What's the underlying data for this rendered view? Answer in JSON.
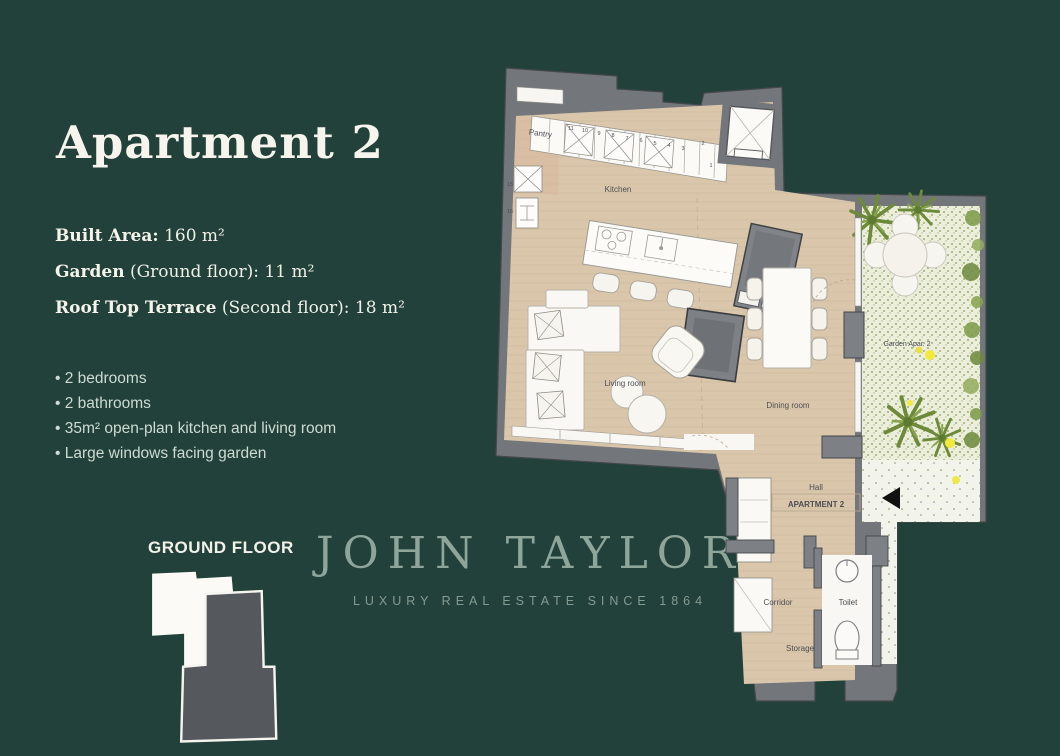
{
  "page": {
    "background": "#22413a"
  },
  "panel": {
    "title": "Apartment 2",
    "specs": [
      {
        "label": "Built Area:",
        "rest": " 160 m²"
      },
      {
        "label": "Garden",
        "rest": " (Ground floor): 11 m²"
      },
      {
        "label": "Roof Top Terrace",
        "rest": " (Second floor): 18 m²"
      }
    ],
    "features": [
      "2 bedrooms",
      "2 bathrooms",
      "35m² open-plan kitchen and living room",
      "Large windows facing garden"
    ],
    "floor_label": "GROUND FLOOR"
  },
  "watermark": {
    "brand": "JOHN TAYLOR",
    "tagline": "LUXURY REAL ESTATE SINCE 1864"
  },
  "plan": {
    "labels": {
      "pantry": "Pantry",
      "kitchen": "Kitchen",
      "living": "Living room",
      "dining": "Dining room",
      "garden": "Garden Apar. 2",
      "hall": "Hall",
      "apartment": "APARTMENT 2",
      "corridor": "Corridor",
      "toilet": "Toilet",
      "storage": "Storage"
    },
    "numbers": {
      "strip": [
        "11",
        "10",
        "9",
        "8",
        "7",
        "6",
        "5",
        "4",
        "3",
        "2"
      ],
      "end": "1",
      "left_top": "15",
      "left_bottom": "16"
    },
    "colors": {
      "wall": "#73767b",
      "wall_dark": "#44474b",
      "floor": "#d9c6ab",
      "pantry_tint": "#d8b89e",
      "white_floor": "#f8f7f3",
      "garden_base": "#eceedd",
      "garden_green": "#6d8a3b",
      "flower_yellow": "#f2ea3a",
      "arrow_black": "#111111"
    }
  }
}
